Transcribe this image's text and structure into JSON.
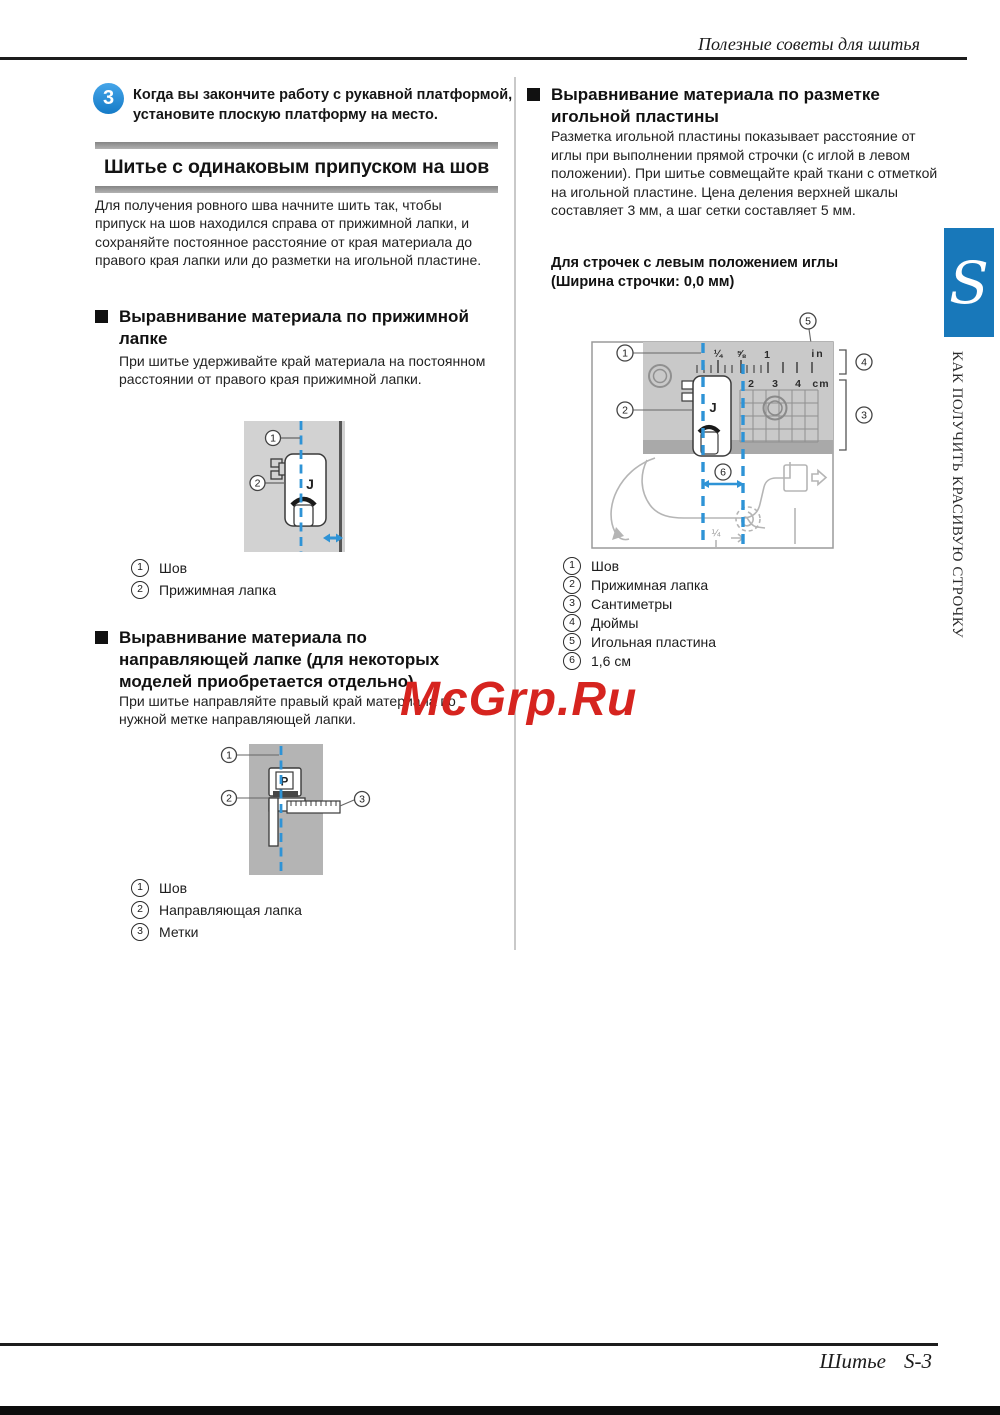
{
  "page": {
    "header_title": "Полезные советы для шитья",
    "footer_label": "Шитье",
    "footer_page": "S-3",
    "watermark": "McGrp.Ru"
  },
  "sidebar": {
    "tab_letter": "S",
    "vertical_text": "КАК ПОЛУЧИТЬ КРАСИВУЮ СТРОЧКУ"
  },
  "step": {
    "number": "3",
    "text": "Когда вы закончите работу с рукавной платформой, установите плоскую платформу на место."
  },
  "section": {
    "title": "Шитье с одинаковым припуском на шов",
    "intro": "Для получения ровного шва начните шить так, чтобы припуск на шов находился справа от прижимной лапки, и сохраняйте постоянное расстояние от края материала до правого края лапки или до разметки на игольной пластине."
  },
  "press_foot": {
    "title": "Выравнивание материала по прижимной лапке",
    "body": "При шитье удерживайте край материала на постоянном расстоянии от правого края прижимной лапки.",
    "diagram": {
      "foot_letter": "J"
    },
    "legend": [
      {
        "num": "1",
        "label": "Шов"
      },
      {
        "num": "2",
        "label": "Прижимная лапка"
      }
    ]
  },
  "guide_foot": {
    "title": "Выравнивание материала по направляющей лапке (для некоторых моделей приобретается отдельно)",
    "body": "При шитье направляйте правый край материала по нужной метке направляющей лапки.",
    "diagram": {
      "foot_letter": "P"
    },
    "legend": [
      {
        "num": "1",
        "label": "Шов"
      },
      {
        "num": "2",
        "label": "Направляющая лапка"
      },
      {
        "num": "3",
        "label": "Метки"
      }
    ]
  },
  "needle_plate": {
    "title": "Выравнивание материала по разметке игольной пластины",
    "body": "Разметка игольной пластины показывает расстояние от иглы при выполнении прямой строчки (с иглой в левом положении). При шитье совмещайте край ткани с отметкой на игольной пластине. Цена деления верхней шкалы составляет 3 мм, а шаг сетки составляет 5 мм.",
    "subhead": "Для строчек с левым положением иглы (Ширина строчки: 0,0 мм)",
    "diagram": {
      "foot_letter": "J",
      "inch_labels": [
        "¼",
        "⅝",
        "1",
        "in"
      ],
      "cm_labels": [
        "2",
        "3",
        "4",
        "cm"
      ],
      "bottom_fraction": "¼"
    },
    "legend": [
      {
        "num": "1",
        "label": "Шов"
      },
      {
        "num": "2",
        "label": "Прижимная лапка"
      },
      {
        "num": "3",
        "label": "Сантиметры"
      },
      {
        "num": "4",
        "label": "Дюймы"
      },
      {
        "num": "5",
        "label": "Игольная пластина"
      },
      {
        "num": "6",
        "label": "1,6 см"
      }
    ]
  },
  "colors": {
    "step_blue": "#2a95df",
    "tab_blue": "#1878ba",
    "dash_blue": "#2e93d6",
    "watermark_red": "#d6241f"
  }
}
